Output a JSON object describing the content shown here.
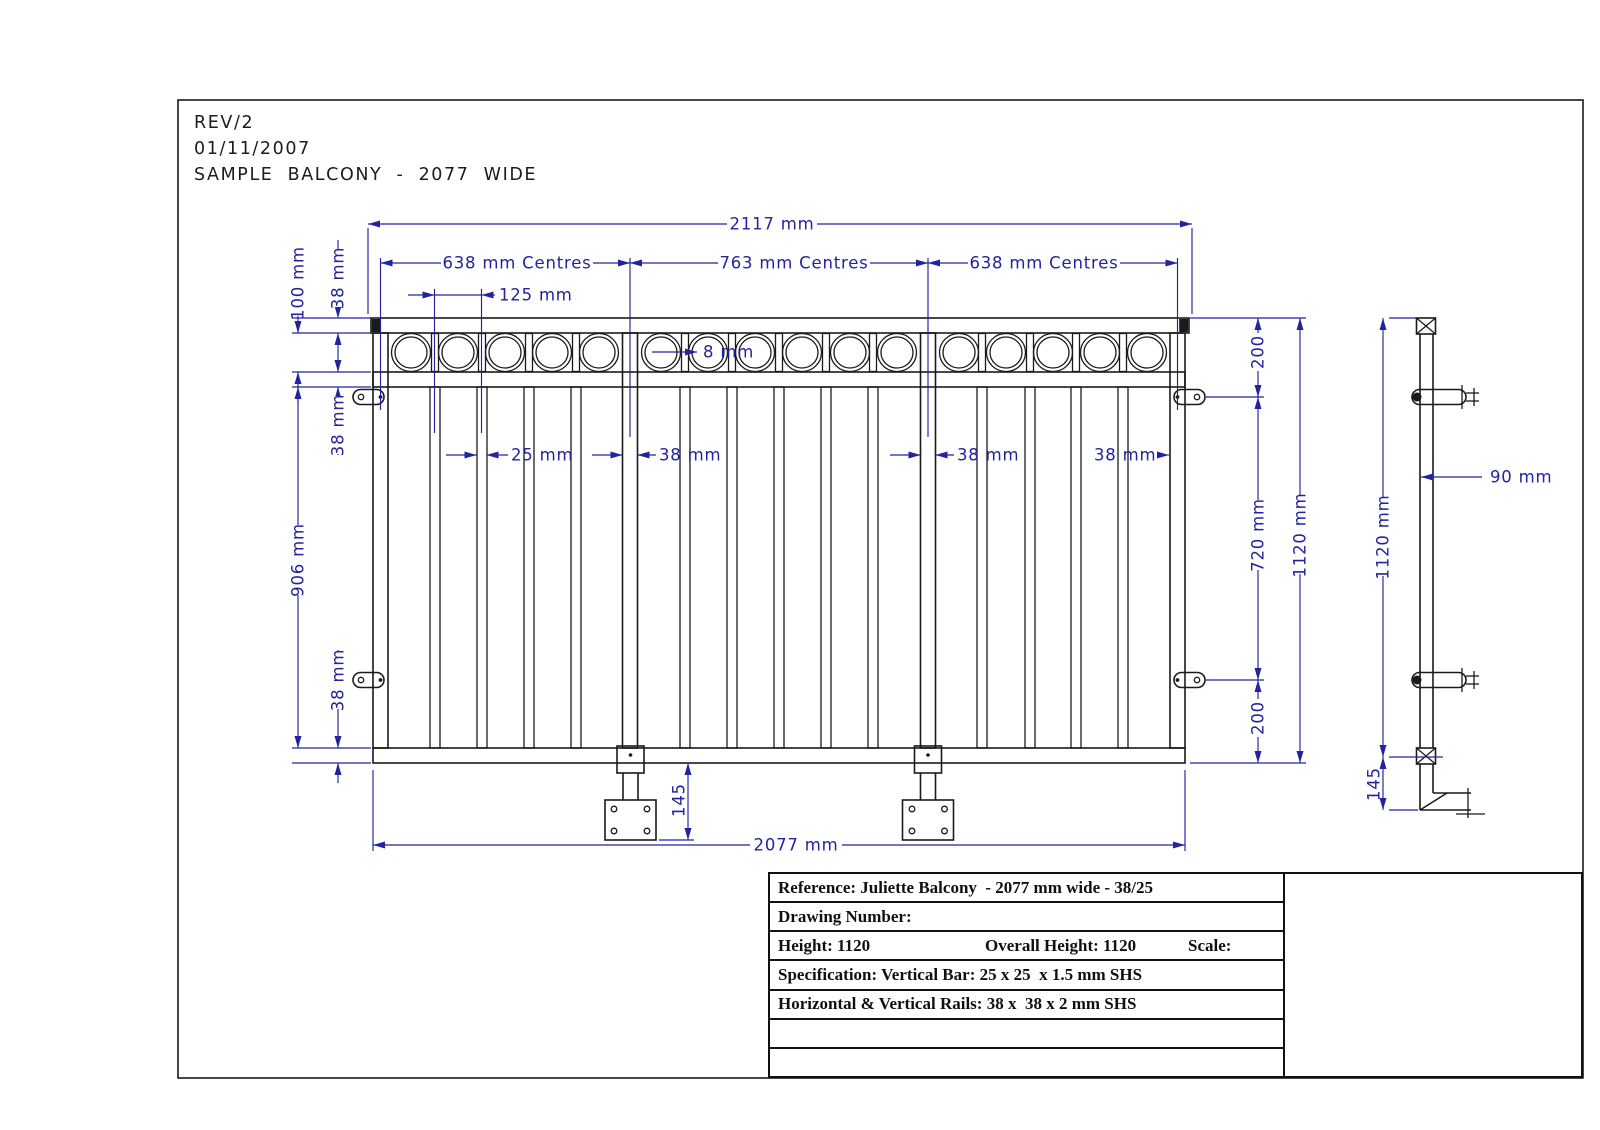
{
  "header": {
    "rev": "REV/2",
    "date": "01/11/2007",
    "title": "SAMPLE BALCONY - 2077 WIDE"
  },
  "front_view": {
    "overall_width_top": "2117 mm",
    "centres_left": "638 mm Centres",
    "centres_mid": "763 mm Centres",
    "centres_right": "638 mm Centres",
    "bar_pitch": "125 mm",
    "ring_wall": "8 mm",
    "band_height": "100 mm",
    "top_rail": "38 mm",
    "mid_rail": "38 mm",
    "infill_height": "906 mm",
    "bottom_rail": "38 mm",
    "baluster_width": "25 mm",
    "upright_width_left": "38 mm",
    "upright_width_right": "38 mm",
    "end_post_width": "38 mm",
    "top_fixing_offset": "200",
    "fixing_spacing": "720 mm",
    "bottom_fixing_offset": "200",
    "overall_height": "1120 mm",
    "overall_width_bottom": "2077 mm",
    "spigot_length": "145"
  },
  "side_view": {
    "overall_height": "1120 mm",
    "handrail_depth": "90 mm",
    "foot_length": "145"
  },
  "title_block": {
    "reference": "Reference: Juliette Balcony  - 2077 mm wide - 38/25",
    "drawing_number": "Drawing Number:",
    "height": "Height: 1120",
    "overall_height": "Overall Height: 1120",
    "scale": "Scale:",
    "specification": "Specification: Vertical Bar: 25 x 25  x 1.5 mm SHS",
    "rails": "Horizontal & Vertical Rails: 38 x  38 x 2 mm SHS"
  },
  "colors": {
    "dimension_blue": "#23239f",
    "line_black": "#1a1a1a",
    "background": "#ffffff"
  }
}
